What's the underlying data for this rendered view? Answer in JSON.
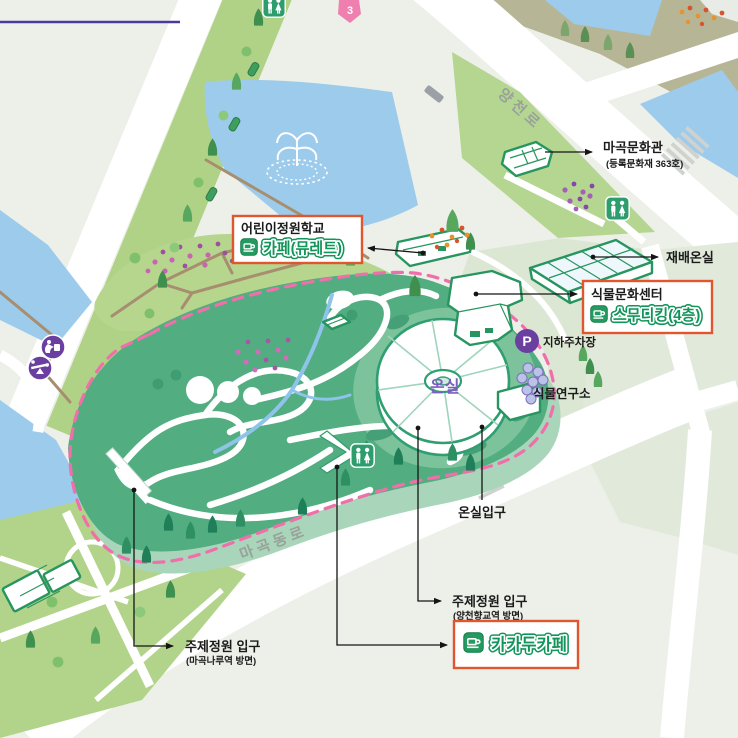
{
  "map": {
    "roads": {
      "yangcheon_ro": "양천로",
      "magokdong_ro": "마곡동로"
    },
    "labels": {
      "magok_culture_house": {
        "title": "마곡문화관",
        "subtitle": "(등록문화재 363호)"
      },
      "cultivation_greenhouse": "재배온실",
      "greenhouse": "온실",
      "greenhouse_entrance": "온실입구",
      "plant_research_institute": "식물연구소",
      "underground_parking": "지하주차장",
      "theme_garden_entrance_east": {
        "title": "주제정원 입구",
        "subtitle": "(양천향교역 방면)"
      },
      "theme_garden_entrance_west": {
        "title": "주제정원 입구",
        "subtitle": "(마곡나루역 방면)"
      }
    },
    "highlight_boxes": {
      "children_garden_school": {
        "title": "어린이정원학교",
        "cafe": "카페(뮤레트)"
      },
      "plant_culture_center": {
        "title": "식물문화센터",
        "cafe": "스무디킹(4층)"
      },
      "kakadu_cafe": {
        "cafe": "카카두카페"
      }
    },
    "badges": {
      "parking": "P",
      "marker_3": "3"
    },
    "icons": [
      "restroom-icon",
      "parking-icon",
      "cafe-icon",
      "fountain-icon",
      "drinking-fountain-icon",
      "seesaw-icon",
      "marker-3-icon"
    ],
    "colors": {
      "highlight_border": "#e0572f",
      "cafe_green": "#12955a",
      "garden_green": "#52ad80",
      "boundary_pink": "#f06fab",
      "parking_purple": "#6a3fa0",
      "water_blue": "#9dcbec",
      "greenhouse_label_purple": "#7b5fc0"
    }
  }
}
